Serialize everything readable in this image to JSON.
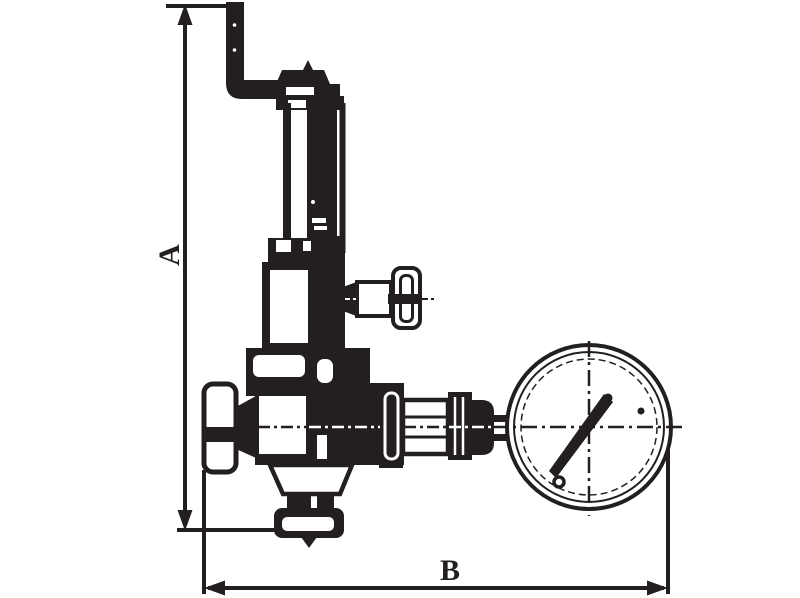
{
  "diagram": {
    "type": "technical-drawing",
    "subject": "pressure reducing valve with pressure gauge",
    "line_color": "#231f20",
    "background_color": "#ffffff",
    "dimension_labels": {
      "vertical": "A",
      "horizontal": "B"
    }
  }
}
